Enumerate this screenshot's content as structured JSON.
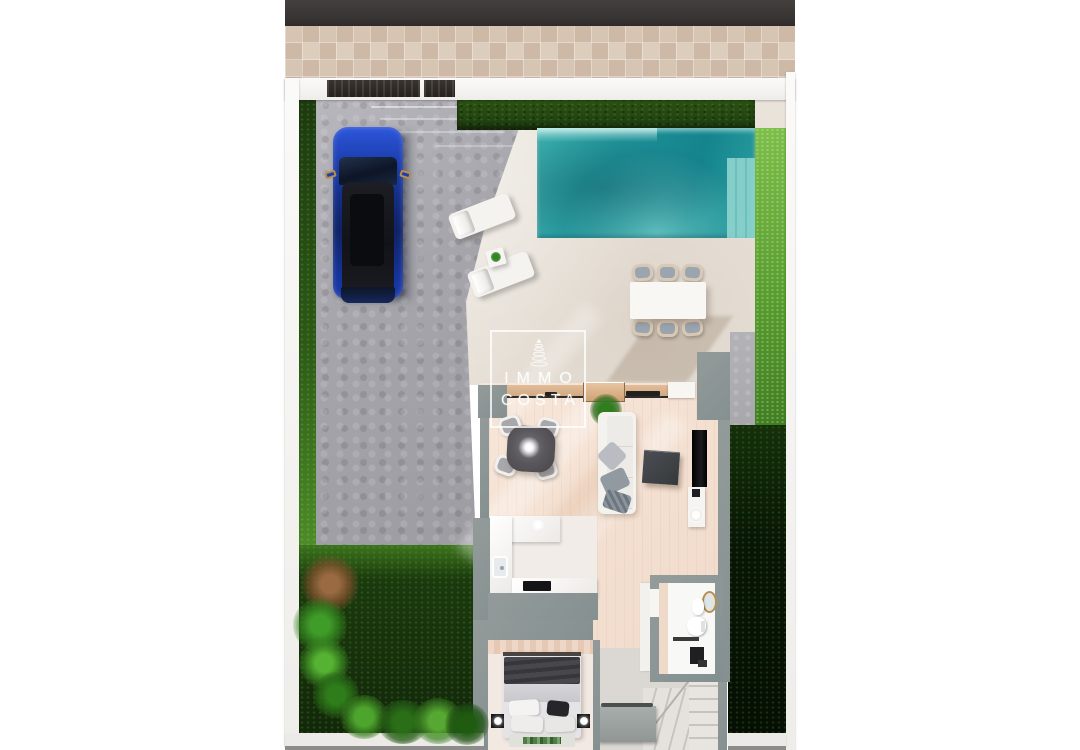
{
  "watermark": {
    "line1": "IMMO",
    "line2": "COSTA",
    "icon": "lighthouse-tower-icon"
  },
  "scene": {
    "kind": "3D top-view render of a villa ground floor",
    "areas": [
      "road",
      "tiled sidewalk",
      "boundary wall",
      "driveway",
      "pool terrace",
      "swimming pool",
      "garden lawn",
      "living-dining room",
      "kitchen",
      "bedroom",
      "bathroom",
      "hallway",
      "staircase"
    ],
    "objects": [
      "entrance gate",
      "pedestrian gate",
      "hedge",
      "blue car",
      "two sun loungers",
      "side table with plant",
      "outdoor dining table with six chairs",
      "pool steps",
      "round dining table with ceiling-lamp glow",
      "four chairs",
      "white sofa with cushions",
      "potted plant",
      "dark coffee table",
      "wall TV",
      "media console with round lamp",
      "kitchen counters with sink and cooktop",
      "double bed with dark blanket and pillows",
      "two black nightstands with lamps",
      "rug",
      "toilet",
      "washbasin",
      "round mirror",
      "shower with black mat",
      "L-shaped winder stairs",
      "built-in wardrobe",
      "palm plants and shrubs"
    ],
    "colors": {
      "page_bg": "#ffffff",
      "road": "#3d3938",
      "sidewalk_tile": "#d3c2b1",
      "wall_white": "#f7f6f3",
      "hedge_dark": "#21400f",
      "grass_bright": "#5d9e33",
      "lawn_dark": "#16300c",
      "driveway_gray": "#a6a6ac",
      "terrace_beige": "#e9e3da",
      "pool_teal": "#1f9097",
      "pool_steps": "#8fd4cf",
      "house_wall_gray": "#8b9393",
      "interior_floor": "#f4e1d3",
      "car_blue": "#1b3cae",
      "furniture_white": "#f4f3f0",
      "coffee_table_dark": "#3f4347",
      "bed_blanket": "#414146",
      "door_wood": "#d2a983"
    }
  }
}
